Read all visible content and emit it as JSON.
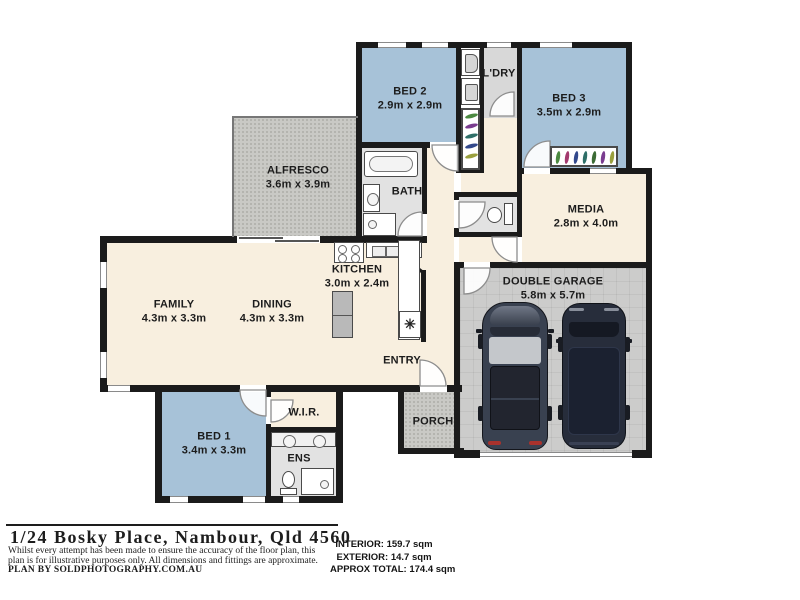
{
  "plan": {
    "rooms": {
      "bed2": {
        "name": "BED 2",
        "dims": "2.9m x 2.9m"
      },
      "ldry": {
        "name": "L'DRY",
        "dims": ""
      },
      "bed3": {
        "name": "BED 3",
        "dims": "3.5m x 2.9m"
      },
      "alfresco": {
        "name": "ALFRESCO",
        "dims": "3.6m x 3.9m"
      },
      "bath": {
        "name": "BATH",
        "dims": ""
      },
      "media": {
        "name": "MEDIA",
        "dims": "2.8m x 4.0m"
      },
      "kitchen": {
        "name": "KITCHEN",
        "dims": "3.0m x 2.4m"
      },
      "family": {
        "name": "FAMILY",
        "dims": "4.3m x 3.3m"
      },
      "dining": {
        "name": "DINING",
        "dims": "4.3m x 3.3m"
      },
      "entry": {
        "name": "ENTRY",
        "dims": ""
      },
      "garage": {
        "name": "DOUBLE GARAGE",
        "dims": "5.8m x 5.7m"
      },
      "bed1": {
        "name": "BED 1",
        "dims": "3.4m x 3.3m"
      },
      "wir": {
        "name": "W.I.R.",
        "dims": ""
      },
      "ens": {
        "name": "ENS",
        "dims": ""
      },
      "porch": {
        "name": "PORCH",
        "dims": ""
      }
    }
  },
  "icons": {
    "pantry": "✳"
  },
  "footer": {
    "address": "1/24 Bosky Place, Nambour, Qld 4560",
    "disclaimer_line1": "Whilst every attempt has been made to ensure the accuracy of the floor plan, this",
    "disclaimer_line2": "plan is for illustrative purposes only. All dimensions and fittings are approximate.",
    "credit": "PLAN BY SOLDPHOTOGRAPHY.COM.AU",
    "areas": {
      "interior": "INTERIOR: 159.7 sqm",
      "exterior": "EXTERIOR: 14.7 sqm",
      "total": "APPROX TOTAL: 174.4 sqm"
    }
  },
  "colors": {
    "wall": "#1b1b1b",
    "floor_cream": "#f8efdf",
    "room_blue": "#a7c2d8",
    "wet_area_gray": "#e2e2e2",
    "outdoor_gray": "#c9c9c5",
    "garage_gray": "#cccccb"
  }
}
